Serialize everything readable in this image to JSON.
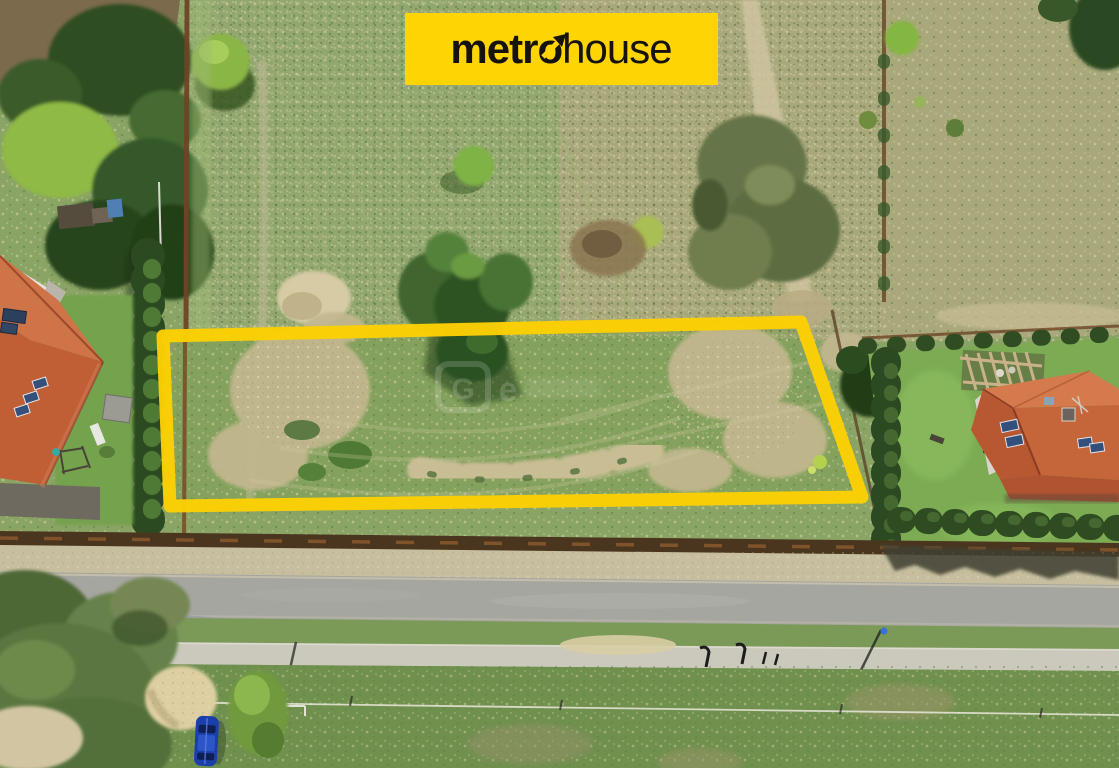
{
  "meta": {
    "description": "Aerial drone photograph of a building plot for sale, marked with a yellow rectangle outline",
    "image_width": 1119,
    "image_height": 768
  },
  "logo": {
    "text_bold": "metro",
    "text_regular": "house",
    "background": "#FFD404",
    "text_color": "#16130f"
  },
  "watermark": {
    "letter_g": "G",
    "letter_e": "e"
  },
  "colors": {
    "plot_outline": "#FCD004",
    "meadow": "#8AA465",
    "dry_grass": "#ABA87C",
    "road": "#A6A6A1",
    "sidewalk": "#CBC9BC",
    "roof_left_house": "#C4603A",
    "roof_right_house": "#C8683C",
    "hedge": "#2F4C23",
    "fence_rust": "#7A4E2A",
    "car": "#1B3FAA",
    "sand": "#DCCFA6"
  },
  "objects": [
    "metrohouse-banner",
    "plot-outline",
    "left-house-orange-roof",
    "right-house-orange-roof",
    "asphalt-road",
    "sidewalk",
    "blue-car",
    "sand-pile",
    "hedge-rows",
    "meadow",
    "portal-watermark"
  ]
}
